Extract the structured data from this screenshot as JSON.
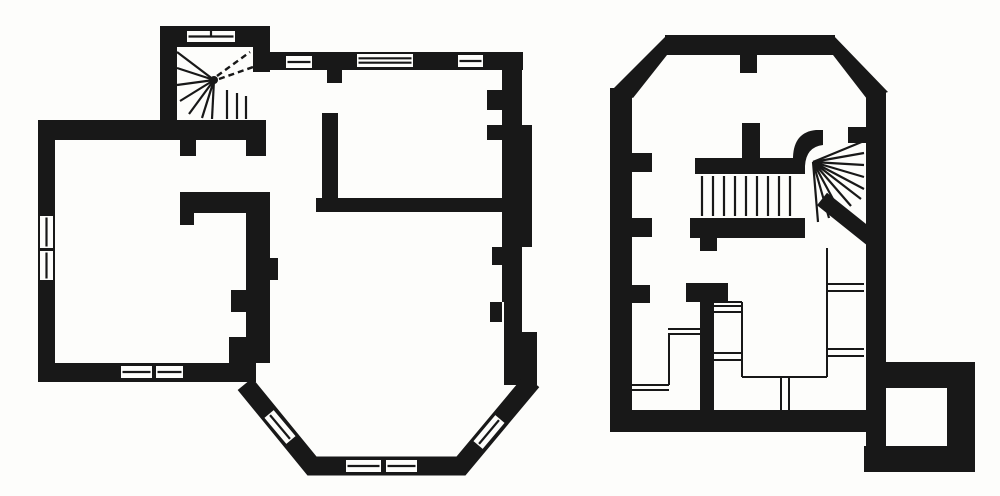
{
  "meta": {
    "description": "Scanned book figure: two black-and-white architectural floor plans drawn with thick poché walls. Left plan has a winding stair turret at top, rooms with slit windows, and a canted bay window at the bottom. Right plan has chamfered top corners, a quarter-turn winder stair, thin-line cellar steps and partitions, and a small square annex room at bottom right."
  },
  "figure": {
    "canvas": {
      "w": 1000,
      "h": 496
    },
    "colors": {
      "background": "#fdfdfb",
      "ink": "#181818",
      "paper": "#fdfdfb"
    },
    "plans": [
      {
        "id": "left-floor-plan",
        "wall_polys": [],
        "wall_rects": [
          {
            "n": "outer-wall-top-left",
            "r": [
              38,
              120,
              228,
              20
            ]
          },
          {
            "n": "outer-wall-left",
            "r": [
              38,
              120,
              17,
              262
            ]
          },
          {
            "n": "outer-wall-bottom-left",
            "r": [
              38,
              363,
              218,
              19
            ]
          },
          {
            "n": "stair-turret-wall-west",
            "r": [
              160,
              26,
              17,
              114
            ]
          },
          {
            "n": "stair-turret-wall-north",
            "r": [
              160,
              26,
              110,
              21
            ]
          },
          {
            "n": "stair-turret-wall-east",
            "r": [
              253,
              26,
              17,
              46
            ]
          },
          {
            "n": "outer-wall-top-right",
            "r": [
              266,
              52,
              257,
              18
            ]
          },
          {
            "n": "door-jamb-west",
            "r": [
              180,
              140,
              16,
              16
            ]
          },
          {
            "n": "door-jamb-east",
            "r": [
              246,
              140,
              20,
              16
            ]
          },
          {
            "n": "hall-partition-wall",
            "r": [
              180,
              192,
              90,
              21
            ]
          },
          {
            "n": "hall-partition-stub",
            "r": [
              180,
              213,
              14,
              12
            ]
          },
          {
            "n": "chimney-wall",
            "r": [
              246,
              192,
              24,
              171
            ]
          },
          {
            "n": "chimney-pier-north",
            "r": [
              231,
              290,
              15,
              22
            ]
          },
          {
            "n": "chimney-pier-south",
            "r": [
              229,
              337,
              17,
              26
            ]
          },
          {
            "n": "chimney-bump",
            "r": [
              270,
              258,
              8,
              22
            ]
          },
          {
            "n": "room-door-stub",
            "r": [
              327,
              70,
              15,
              13
            ]
          },
          {
            "n": "room-partition-west",
            "r": [
              322,
              113,
              16,
              85
            ]
          },
          {
            "n": "room-partition-south",
            "r": [
              316,
              198,
              187,
              14
            ]
          },
          {
            "n": "outer-wall-right-upper",
            "r": [
              502,
              70,
              20,
              55
            ]
          },
          {
            "n": "pilaster-upper",
            "r": [
              487,
              90,
              15,
              20
            ]
          },
          {
            "n": "pilaster-lower",
            "r": [
              487,
              125,
              15,
              15
            ]
          },
          {
            "n": "outer-wall-right-mid",
            "r": [
              502,
              125,
              30,
              122
            ]
          },
          {
            "n": "wall-bump-a",
            "r": [
              492,
              247,
              10,
              18
            ]
          },
          {
            "n": "outer-wall-right-lower",
            "r": [
              502,
              247,
              20,
              55
            ]
          },
          {
            "n": "wall-bump-b",
            "r": [
              490,
              302,
              12,
              20
            ]
          },
          {
            "n": "outer-wall-right-d",
            "r": [
              504,
              302,
              18,
              30
            ]
          },
          {
            "n": "outer-wall-right-e",
            "r": [
              504,
              332,
              33,
              53
            ]
          }
        ],
        "wall_strokes": [
          {
            "n": "bay-window-wall",
            "pts": [
              [
                245,
                384
              ],
              [
                312,
                466
              ],
              [
                461,
                466
              ],
              [
                532,
                381
              ]
            ],
            "w": 19
          }
        ],
        "wall_paths": [],
        "windows": [
          {
            "n": "turret-window",
            "x": 187,
            "y": 31,
            "w": 48,
            "h": 11,
            "lines": 1,
            "tick": true
          },
          {
            "n": "window-north-1",
            "x": 286,
            "y": 56,
            "w": 26,
            "h": 12,
            "lines": 1
          },
          {
            "n": "window-north-2",
            "x": 357,
            "y": 54,
            "w": 56,
            "h": 13,
            "lines": 2
          },
          {
            "n": "window-north-3",
            "x": 458,
            "y": 55,
            "w": 25,
            "h": 12,
            "lines": 1
          },
          {
            "n": "window-west-1",
            "x": 40,
            "y": 216,
            "w": 13,
            "h": 32,
            "lines": 1
          },
          {
            "n": "window-west-2",
            "x": 40,
            "y": 251,
            "w": 13,
            "h": 29,
            "lines": 1
          },
          {
            "n": "window-south-1",
            "x": 121,
            "y": 366,
            "w": 31,
            "h": 12,
            "lines": 1
          },
          {
            "n": "window-south-2",
            "x": 156,
            "y": 366,
            "w": 27,
            "h": 12,
            "lines": 1
          },
          {
            "n": "bay-window-left",
            "x": 263,
            "y": 421,
            "w": 34,
            "h": 12,
            "rot": 50,
            "lines": 1
          },
          {
            "n": "bay-window-bottom-1",
            "x": 346,
            "y": 460,
            "w": 35,
            "h": 12,
            "lines": 1
          },
          {
            "n": "bay-window-bottom-2",
            "x": 386,
            "y": 460,
            "w": 31,
            "h": 12,
            "lines": 1
          },
          {
            "n": "bay-window-right",
            "x": 472,
            "y": 426,
            "w": 34,
            "h": 12,
            "rot": -50,
            "lines": 1
          }
        ],
        "stair_lines": [
          [
            214,
            80,
            177,
            52
          ],
          [
            214,
            80,
            177,
            68
          ],
          [
            214,
            80,
            177,
            85
          ],
          [
            214,
            80,
            180,
            101
          ],
          [
            214,
            80,
            189,
            114
          ],
          [
            214,
            80,
            202,
            118
          ],
          [
            214,
            80,
            212,
            119
          ],
          [
            227,
            90,
            227,
            119
          ],
          [
            237,
            93,
            237,
            119
          ],
          [
            246,
            96,
            246,
            119
          ]
        ],
        "dashed_lines": [
          [
            217,
            76,
            250,
            52
          ],
          [
            219,
            79,
            256,
            66
          ]
        ],
        "thin_lines": [],
        "dots": [
          [
            214,
            80,
            4
          ]
        ]
      },
      {
        "id": "right-floor-plan",
        "wall_polys": [
          {
            "n": "chamfer-northwest",
            "pts": [
              [
                667,
                35
              ],
              [
                612,
                90
              ],
              [
                633,
                98
              ],
              [
                667,
                55
              ]
            ]
          },
          {
            "n": "chamfer-northeast",
            "pts": [
              [
                833,
                35
              ],
              [
                888,
                92
              ],
              [
                867,
                99
              ],
              [
                833,
                55
              ]
            ]
          }
        ],
        "wall_rects": [
          {
            "n": "outer-wall-north",
            "r": [
              665,
              35,
              170,
              20
            ]
          },
          {
            "n": "outer-wall-west",
            "r": [
              610,
              88,
              22,
              344
            ]
          },
          {
            "n": "outer-wall-east",
            "r": [
              866,
              90,
              20,
              358
            ]
          },
          {
            "n": "outer-wall-south",
            "r": [
              610,
              410,
              256,
              22
            ]
          },
          {
            "n": "pier-north",
            "r": [
              740,
              55,
              17,
              18
            ]
          },
          {
            "n": "pier-west-1",
            "r": [
              632,
              153,
              20,
              19
            ]
          },
          {
            "n": "pier-west-2",
            "r": [
              632,
              218,
              20,
              19
            ]
          },
          {
            "n": "pier-west-3",
            "r": [
              632,
              285,
              18,
              18
            ]
          },
          {
            "n": "pier-east",
            "r": [
              848,
              127,
              18,
              16
            ]
          },
          {
            "n": "stair-wall-upper",
            "r": [
              695,
              158,
              100,
              16
            ]
          },
          {
            "n": "stair-wall-stub",
            "r": [
              742,
              123,
              18,
              37
            ]
          },
          {
            "n": "stair-wall-lower",
            "r": [
              690,
              218,
              115,
              20
            ]
          },
          {
            "n": "stair-wall-lower-stub",
            "r": [
              700,
              238,
              17,
              13
            ]
          },
          {
            "n": "partition-head",
            "r": [
              686,
              283,
              42,
              19
            ]
          },
          {
            "n": "partition-stem",
            "r": [
              700,
              283,
              14,
              130
            ]
          },
          {
            "n": "annex-wall-north",
            "r": [
              884,
              362,
              91,
              26
            ]
          },
          {
            "n": "annex-wall-east",
            "r": [
              947,
              362,
              28,
              110
            ]
          },
          {
            "n": "annex-wall-south",
            "r": [
              864,
              446,
              111,
              26
            ]
          }
        ],
        "wall_strokes": [
          {
            "n": "stair-diagonal-wall",
            "pts": [
              [
                822,
                199
              ],
              [
                877,
                243
              ]
            ],
            "w": 16
          }
        ],
        "wall_paths": [
          {
            "n": "stair-curved-wall",
            "d": "M 793,174 L 793,157 Q 794,132 816,130 L 823,130 L 823,145 Q 806,147 805,166 L 805,174 Z"
          }
        ],
        "windows": [],
        "stair_lines": [
          [
            702,
            176,
            702,
            216
          ],
          [
            713,
            176,
            713,
            216
          ],
          [
            724,
            176,
            724,
            216
          ],
          [
            735,
            176,
            735,
            216
          ],
          [
            746,
            176,
            746,
            216
          ],
          [
            757,
            176,
            757,
            216
          ],
          [
            768,
            176,
            768,
            216
          ],
          [
            779,
            176,
            779,
            216
          ],
          [
            790,
            176,
            790,
            216
          ],
          [
            813,
            162,
            864,
            141
          ],
          [
            813,
            162,
            864,
            153
          ],
          [
            813,
            162,
            864,
            165
          ],
          [
            813,
            162,
            864,
            177
          ],
          [
            813,
            162,
            864,
            189
          ],
          [
            813,
            162,
            861,
            199
          ],
          [
            813,
            162,
            851,
            206
          ],
          [
            813,
            162,
            840,
            212
          ],
          [
            813,
            162,
            829,
            218
          ],
          [
            813,
            162,
            818,
            222
          ]
        ],
        "dashed_lines": [],
        "thin_lines": [
          [
            668,
            329,
            700,
            329
          ],
          [
            668,
            334,
            700,
            334
          ],
          [
            669,
            334,
            669,
            385
          ],
          [
            630,
            385,
            669,
            385
          ],
          [
            630,
            390,
            669,
            390
          ],
          [
            714,
            306,
            742,
            306
          ],
          [
            714,
            312,
            742,
            312
          ],
          [
            714,
            353,
            742,
            353
          ],
          [
            714,
            360,
            742,
            360
          ],
          [
            714,
            302,
            742,
            302
          ],
          [
            742,
            302,
            742,
            377
          ],
          [
            742,
            377,
            827,
            377
          ],
          [
            827,
            248,
            827,
            377
          ],
          [
            828,
            284,
            864,
            284
          ],
          [
            828,
            291,
            864,
            291
          ],
          [
            828,
            349,
            864,
            349
          ],
          [
            828,
            356,
            864,
            356
          ],
          [
            781,
            378,
            781,
            412
          ],
          [
            789,
            378,
            789,
            412
          ]
        ],
        "dots": []
      }
    ]
  }
}
